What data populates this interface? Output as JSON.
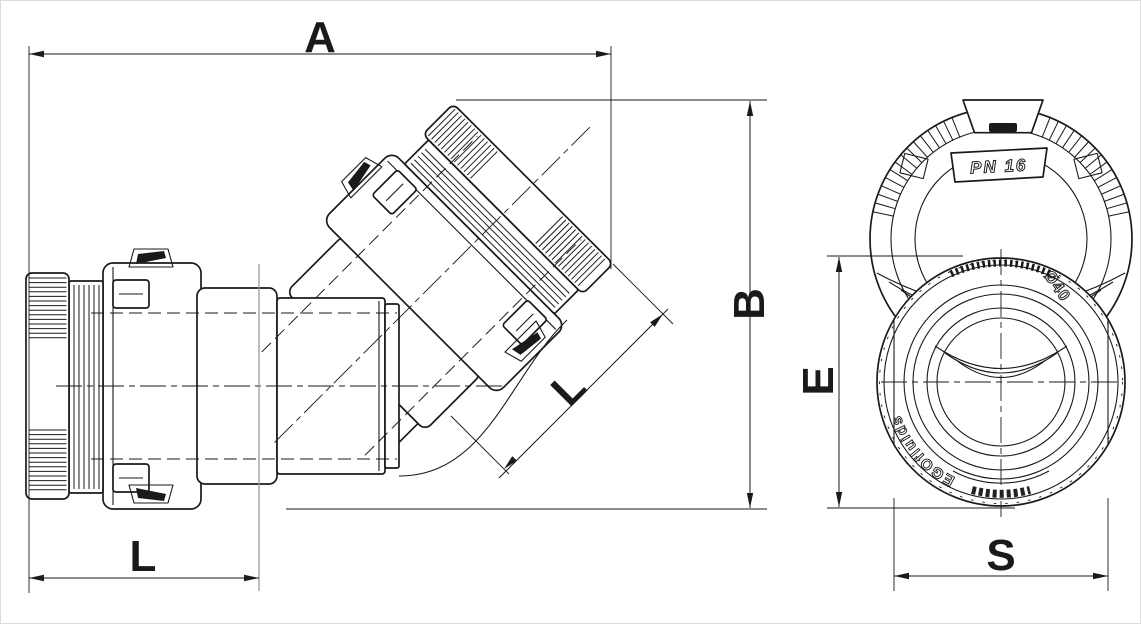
{
  "drawing": {
    "dimensions": {
      "a": "A",
      "b": "B",
      "l_diagonal": "L",
      "l_socket_depth": "L",
      "e": "E",
      "s": "S"
    },
    "markings": {
      "pressure_rating": "PN 16",
      "diameter": "Ø40",
      "brand": "EGOfluids"
    },
    "colors": {
      "line": "#1a1a1a",
      "background": "#ffffff",
      "extension_witness": "#9a9a9a"
    }
  }
}
